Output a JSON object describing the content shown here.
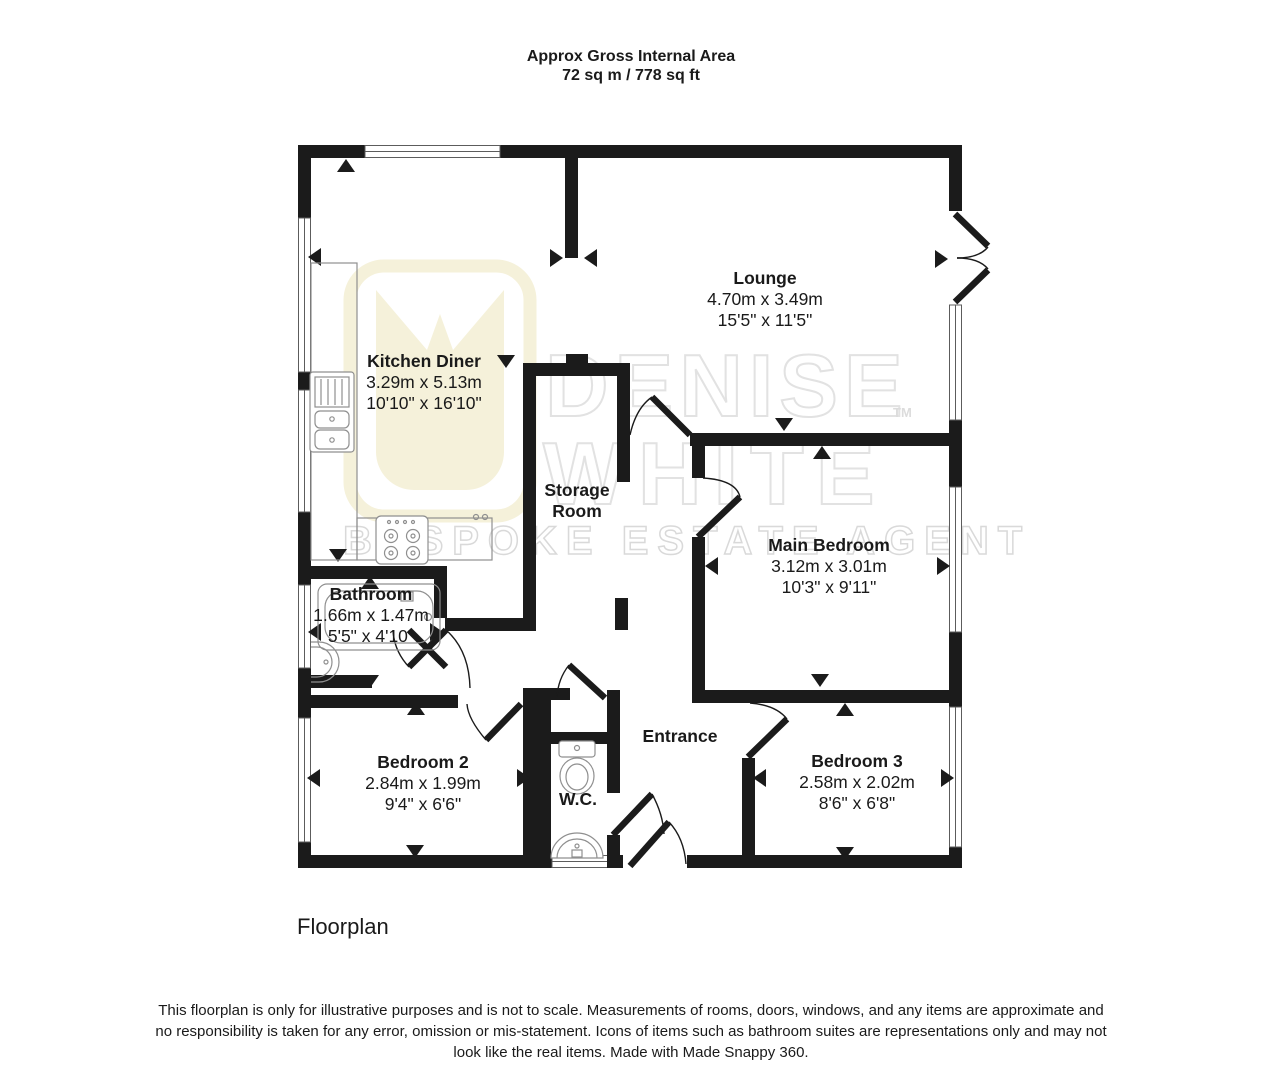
{
  "title": {
    "line1": "Approx Gross Internal Area",
    "line2": "72 sq m / 778 sq ft"
  },
  "rooms": {
    "kitchen": {
      "name": "Kitchen Diner",
      "metric": "3.29m x 5.13m",
      "imperial": "10'10\" x 16'10\""
    },
    "lounge": {
      "name": "Lounge",
      "metric": "4.70m x 3.49m",
      "imperial": "15'5\" x 11'5\""
    },
    "storage": {
      "name_line1": "Storage",
      "name_line2": "Room"
    },
    "main_bedroom": {
      "name": "Main Bedroom",
      "metric": "3.12m x 3.01m",
      "imperial": "10'3\" x 9'11\""
    },
    "bathroom": {
      "name": "Bathroom",
      "metric": "1.66m x 1.47m",
      "imperial": "5'5\" x 4'10\""
    },
    "bedroom2": {
      "name": "Bedroom 2",
      "metric": "2.84m x 1.99m",
      "imperial": "9'4\" x 6'6\""
    },
    "wc": {
      "name": "W.C."
    },
    "entrance": {
      "name": "Entrance"
    },
    "bedroom3": {
      "name": "Bedroom 3",
      "metric": "2.58m x 2.02m",
      "imperial": "8'6\" x 6'8\""
    }
  },
  "watermark": {
    "line1": "DENISE",
    "line2": "WHITE",
    "tm": "TM",
    "tagline": "BESPOKE ESTATE AGENT"
  },
  "footer": {
    "caption": "Floorplan",
    "disclaimer": "This floorplan is only for illustrative purposes and is not to scale. Measurements of rooms, doors, windows, and any items are approximate and no responsibility is taken for any error, omission or mis-statement. Icons of items such as bathroom suites are representations only and may not look like the real items. Made with Made Snappy 360."
  },
  "colors": {
    "wall": "#1b1b1b",
    "fixture": "#8f8f8f",
    "watermark_outline": "#e2e2e2",
    "logo": "#f5f1da"
  }
}
